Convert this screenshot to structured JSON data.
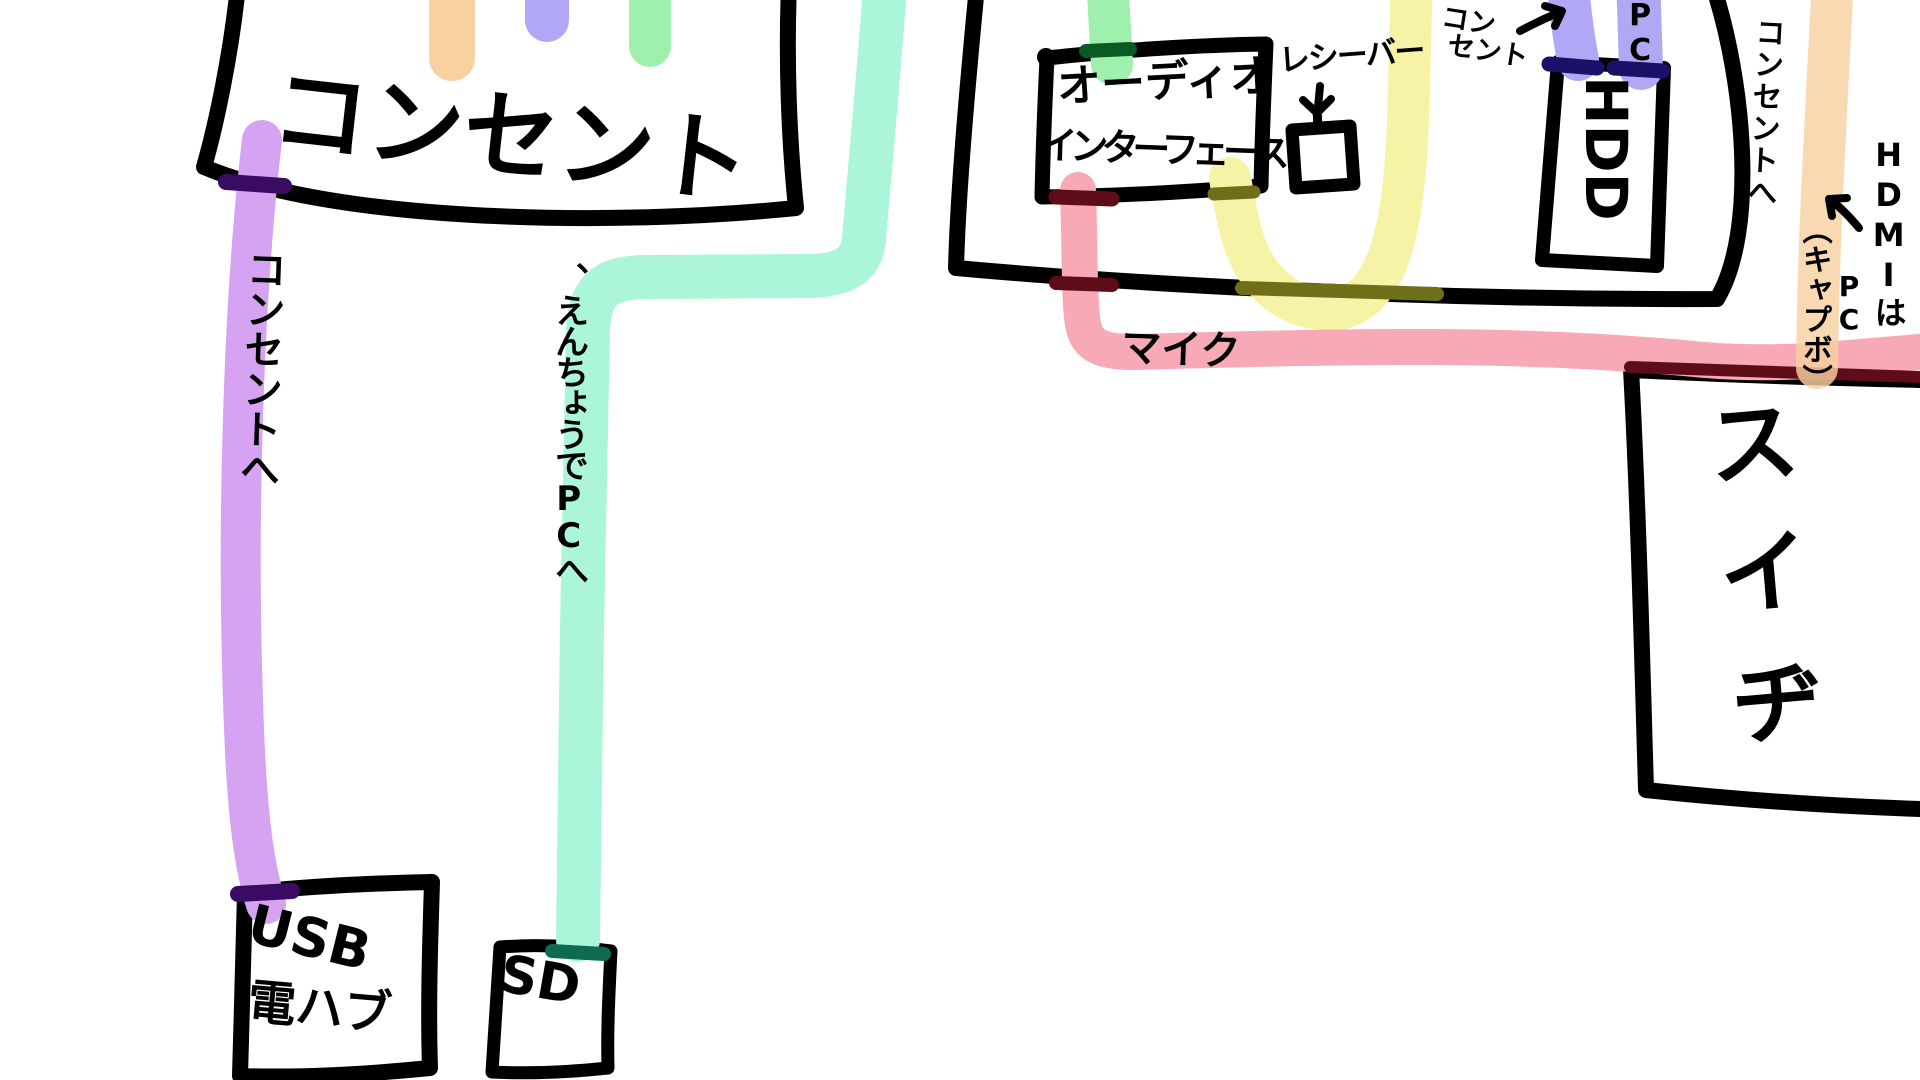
{
  "canvas": {
    "width": 1920,
    "height": 1080,
    "background": "#FFFFFF",
    "ink": "#000000"
  },
  "colors": {
    "orange": "#F8D1A0",
    "periwinkle": "#B1A8F5",
    "green": "#9FEFAD",
    "teal": "#ABF5D9",
    "purple": "#D6A3F2",
    "pink": "#F8A9B6",
    "yellow": "#F7F3A6"
  },
  "boxes": {
    "outlet": {
      "label": "コンセント"
    },
    "audio_interface": {
      "label_line1": "オーディオ",
      "label_line2": "インターフェース"
    },
    "receiver": {
      "label": "レシーバー"
    },
    "hdd": {
      "label": "HDD"
    },
    "switch": {
      "label": "スイヂ"
    },
    "usb_hub": {
      "label_line1": "USB",
      "label_line2": "電ハブ"
    },
    "sd": {
      "label": "SD"
    }
  },
  "annotations": {
    "purple_cable_label": "コンセントへ",
    "teal_cable_label": "、えんちょうでPCへ",
    "mic_label": "マイク",
    "outlet_arrow_note_line1": "コン",
    "outlet_arrow_note_line2": "セント",
    "pc_top_label": "PC",
    "orange_cable_label": "コンセントへ",
    "hdmi_note": "HDMIは",
    "hdmi_pc_label": "PC",
    "capture_board_note": "（キャプボ）"
  }
}
